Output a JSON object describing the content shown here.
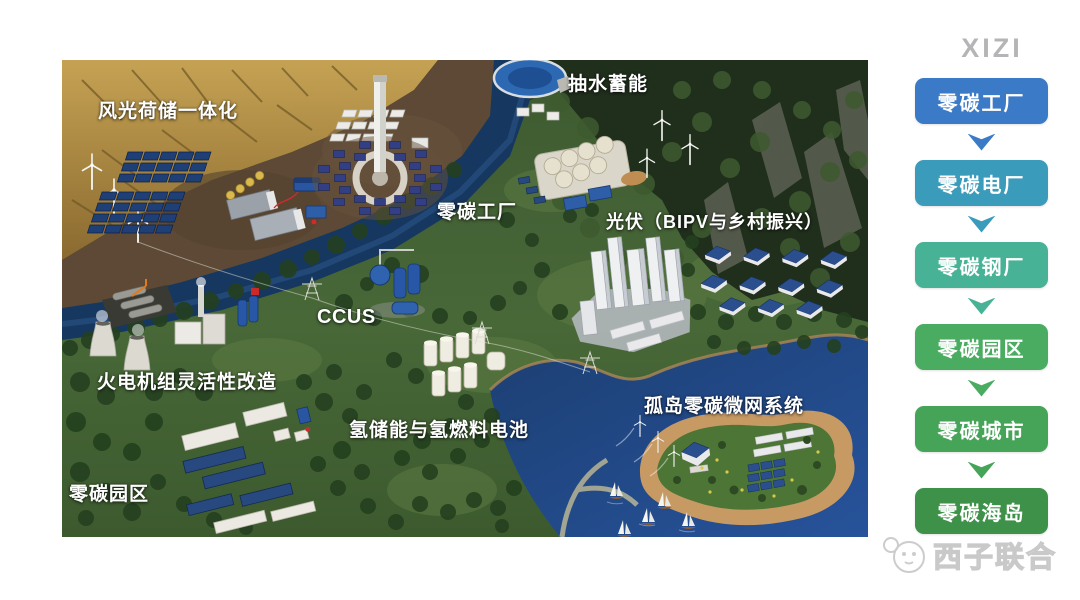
{
  "brand": {
    "logo_text": "XIZI",
    "logo_color": "#b5b5b7",
    "watermark_text": "西子联合"
  },
  "scene_labels": {
    "integration": "风光荷储一体化",
    "pumped_storage": "抽水蓄能",
    "zero_carbon_factory": "零碳工厂",
    "pv_bipv": "光伏（BIPV与乡村振兴）",
    "ccus": "CCUS",
    "thermal_flex": "火电机组灵活性改造",
    "hydrogen": "氢储能与氢燃料电池",
    "island_microgrid": "孤岛零碳微网系统",
    "zero_carbon_park": "零碳园区"
  },
  "sidebar": {
    "flow": [
      {
        "label": "零碳工厂",
        "color": "#3b7ac7"
      },
      {
        "label": "零碳电厂",
        "color": "#3a9bbb"
      },
      {
        "label": "零碳钢厂",
        "color": "#47b295"
      },
      {
        "label": "零碳园区",
        "color": "#4aac61"
      },
      {
        "label": "零碳城市",
        "color": "#46a458"
      },
      {
        "label": "零碳海岛",
        "color": "#3e9149"
      }
    ]
  }
}
